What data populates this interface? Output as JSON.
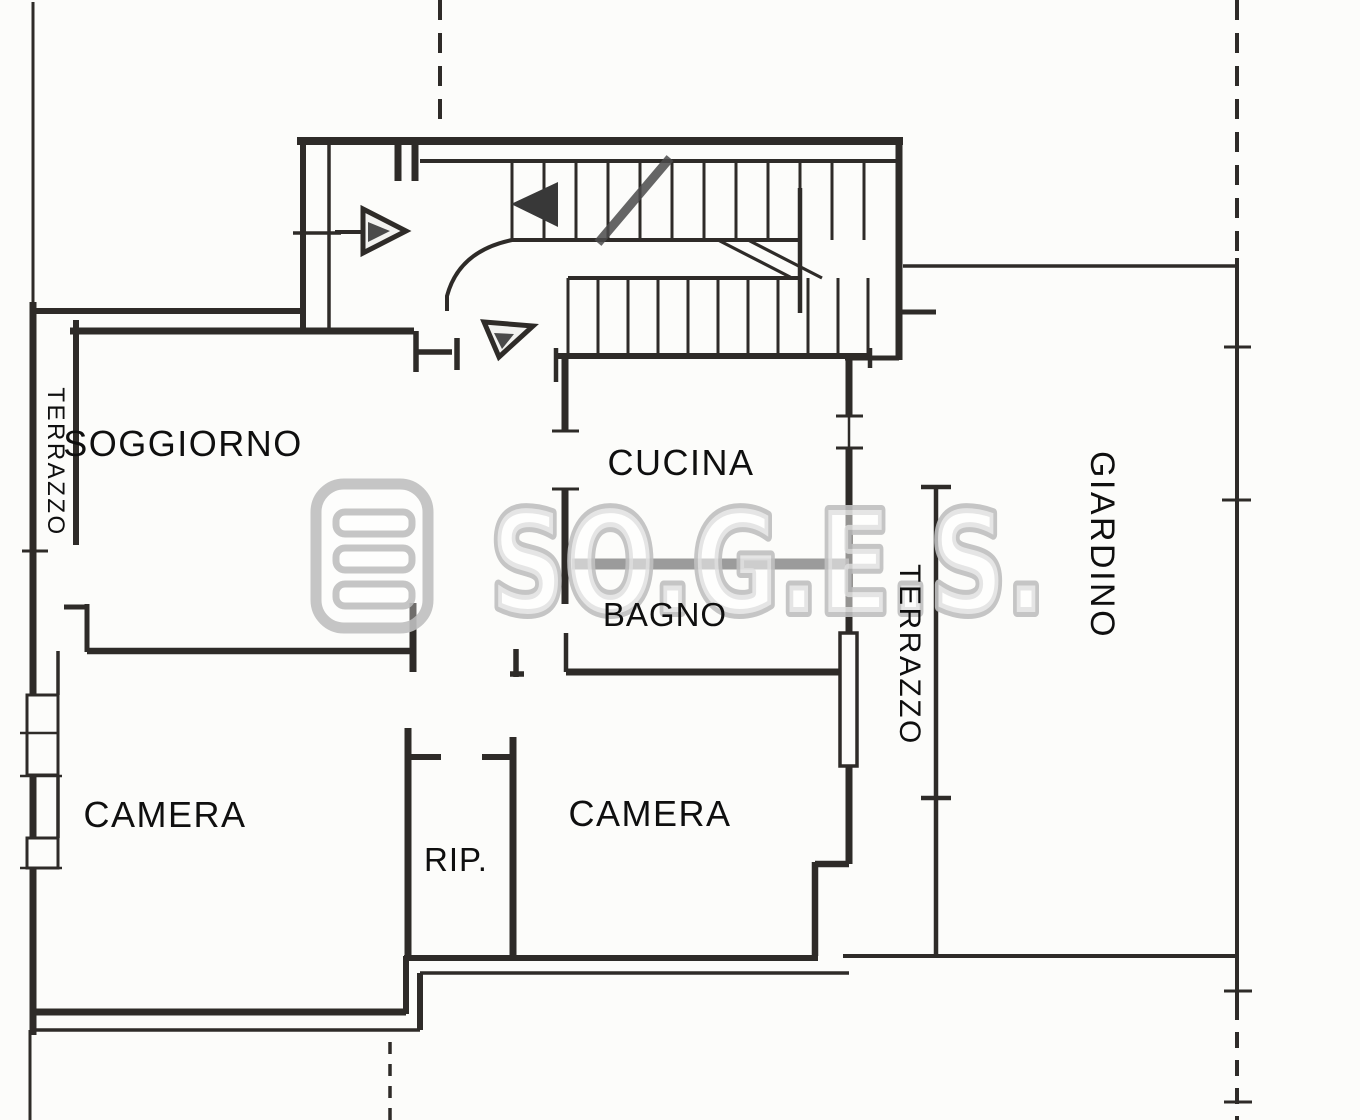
{
  "plan": {
    "title": "apartment-floor-plan",
    "rooms": [
      {
        "id": "soggiorno",
        "label": "SOGGIORNO"
      },
      {
        "id": "cucina",
        "label": "CUCINA"
      },
      {
        "id": "bagno",
        "label": "BAGNO"
      },
      {
        "id": "camera-left",
        "label": "CAMERA"
      },
      {
        "id": "camera-right",
        "label": "CAMERA"
      },
      {
        "id": "ripostiglio",
        "label": "RIP."
      },
      {
        "id": "terrazzo-left",
        "label": "TERRAZZO"
      },
      {
        "id": "terrazzo-right",
        "label": "TERRAZZO"
      },
      {
        "id": "giardino",
        "label": "GIARDINO"
      }
    ],
    "watermark": {
      "text": "SO.G.E.S.",
      "logo": "soges-logo"
    },
    "colors": {
      "paper": "#fcfcfa",
      "ink": "#2e2b28",
      "pencil": "#8a8a8a",
      "watermark": "#c0c0c0"
    }
  }
}
